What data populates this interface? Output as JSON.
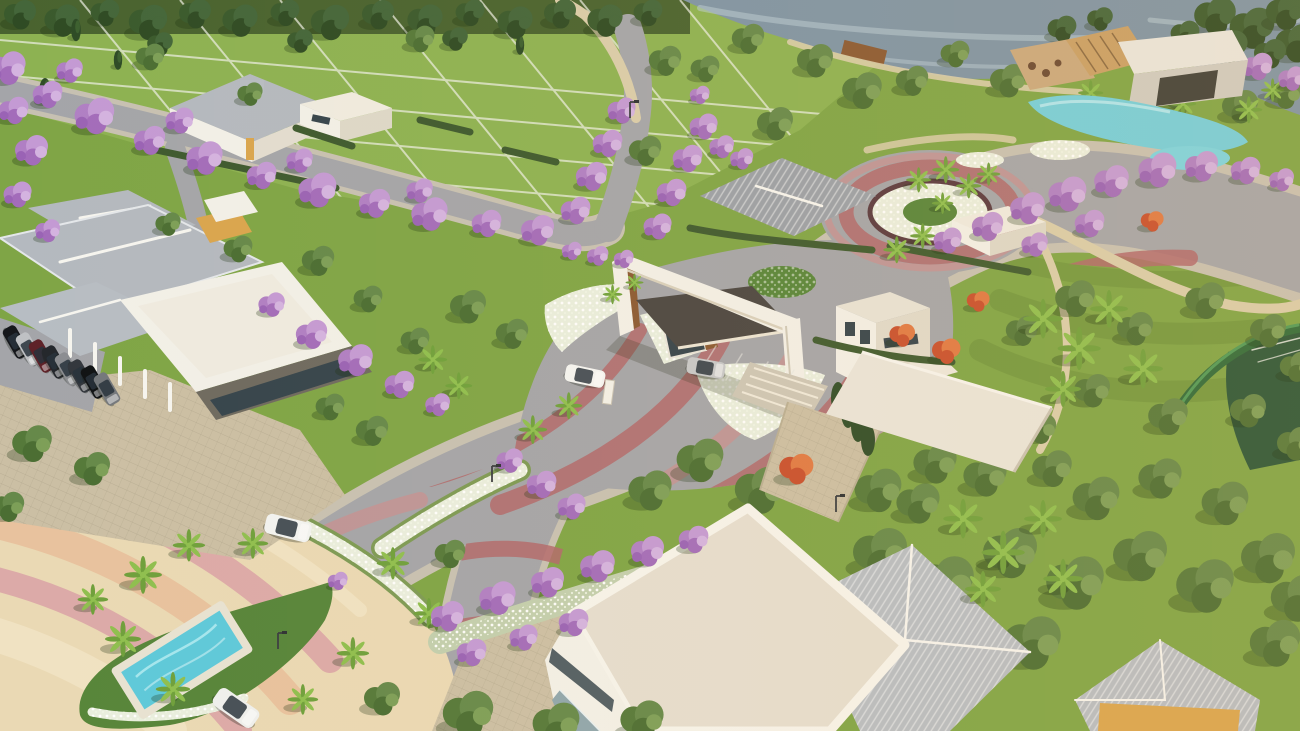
{
  "meta": {
    "title": "Aerial 3D render of a gated residential community entrance",
    "canvas": {
      "width": 1300,
      "height": 731
    }
  },
  "scene": {
    "description": "Sunset aerial rendering: main entrance portal with guard booth and canopy, curved boulevard with red decorative paving stripes, jacaranda-lined streets, landscaped roundabout, lakeside clubhouse with lagoon pools, residential lawn lots, palm islands with a small pool, sports court, and dense tree groves.",
    "landmarks": [
      "lake",
      "lakeside-clubhouse",
      "lagoon-pools",
      "boat-dock",
      "entrance-portal",
      "guard-booth",
      "roundabout-garden",
      "main-boulevard",
      "striped-plaza",
      "pool-island",
      "left-clubhouse",
      "parking-row",
      "white-flat-roof-building",
      "ribbed-roof-building",
      "sports-court",
      "residential-lots"
    ]
  },
  "palette": {
    "lawn": "#7fa546",
    "lawnLight": "#8db252",
    "forest": "#49632f",
    "water": "#7e94a5",
    "waterLight": "#bccfd9",
    "road": "#a4a5a9",
    "sidewalk": "#c7c1b2",
    "stripe": "#b2696c",
    "stripeLight": "#c98f90",
    "plazaCream": "#ead9b4",
    "bandPink": "#dcaaa8",
    "bandPeach": "#e8c29e",
    "bandLight": "#f0e2c2",
    "pathBeige": "#d9cdaa",
    "paver": "#cbbfa4",
    "white": "#f2f0e8",
    "cream": "#efebe0",
    "roofGray": "#b4b9bf",
    "roofRib": "#b7bdc3",
    "wood": "#8a5a33",
    "woodLight": "#c9a066",
    "canopy": "#4a4642",
    "glass": "#35444c",
    "yellow": "#d9a54e",
    "bedCream": "#e9eede",
    "bedGreen": "#7d9a55",
    "island": "#57853a",
    "pool": "#5ec9da",
    "deck": "#e8e2d2",
    "court": "#2a5638",
    "hedge": "#3e5a2f",
    "tree1": "#55793a",
    "tree2": "#66894a",
    "tree3": "#4b6e33",
    "tree4": "#7d9f58",
    "dark1": "#3a5a2d",
    "dark2": "#44663a",
    "dark3": "#2f4b24",
    "palm": "#6fa03c",
    "palmHi": "#8fbf4f",
    "trunk": "#7a6248",
    "jac1": "#b07fc4",
    "jac2": "#c49ad4",
    "jac3": "#a36cba",
    "jac4": "#d4b3e0",
    "jac5": "#9a63b5",
    "conif": "#2e4b26",
    "conifHi": "#3d6030",
    "flame1": "#c8502e",
    "flame2": "#e07a44",
    "shadow": "rgba(25,45,15,0.28)"
  },
  "vegetation": {
    "back": {
      "d": [
        [
          20,
          16,
          1.0
        ],
        [
          62,
          22,
          1.1
        ],
        [
          105,
          14,
          0.9
        ],
        [
          148,
          24,
          1.2
        ],
        [
          195,
          15,
          1.0
        ],
        [
          240,
          22,
          1.1
        ],
        [
          285,
          14,
          0.9
        ],
        [
          330,
          24,
          1.2
        ],
        [
          378,
          16,
          1.0
        ],
        [
          425,
          22,
          1.1
        ],
        [
          470,
          14,
          0.9
        ],
        [
          515,
          24,
          1.1
        ],
        [
          560,
          15,
          1.0
        ],
        [
          605,
          22,
          1.1
        ],
        [
          648,
          14,
          0.9
        ],
        [
          455,
          40,
          0.8
        ],
        [
          300,
          42,
          0.8
        ],
        [
          160,
          45,
          0.8
        ],
        [
          1215,
          18,
          1.3
        ],
        [
          1252,
          30,
          1.4
        ],
        [
          1285,
          14,
          1.2
        ],
        [
          1296,
          45,
          1.3
        ],
        [
          1230,
          48,
          1.1
        ],
        [
          1270,
          55,
          1.0
        ],
        [
          1185,
          35,
          0.9
        ],
        [
          1062,
          30,
          0.9
        ],
        [
          1100,
          20,
          0.8
        ]
      ],
      "c": [
        [
          45,
          92,
          1.0
        ],
        [
          76,
          30,
          0.8
        ],
        [
          520,
          45,
          0.7
        ],
        [
          118,
          60,
          0.7
        ]
      ],
      "t": [
        [
          748,
          40,
          0.9
        ],
        [
          815,
          62,
          1.0
        ],
        [
          862,
          92,
          1.1
        ],
        [
          912,
          82,
          0.9
        ],
        [
          955,
          55,
          0.8
        ],
        [
          1008,
          82,
          1.0
        ],
        [
          1175,
          92,
          1.1
        ],
        [
          1240,
          108,
          1.0
        ],
        [
          1285,
          95,
          0.9
        ],
        [
          705,
          70,
          0.8
        ],
        [
          150,
          58,
          0.8
        ],
        [
          420,
          40,
          0.8
        ],
        [
          665,
          62,
          0.9
        ],
        [
          775,
          125,
          1.0
        ],
        [
          645,
          152,
          0.9
        ],
        [
          250,
          95,
          0.7
        ],
        [
          168,
          225,
          0.7
        ],
        [
          238,
          250,
          0.8
        ],
        [
          1075,
          300,
          1.1
        ],
        [
          1135,
          330,
          1.0
        ],
        [
          1205,
          302,
          1.1
        ],
        [
          1268,
          332,
          1.0
        ],
        [
          1092,
          392,
          1.0
        ],
        [
          1168,
          418,
          1.1
        ],
        [
          1248,
          412,
          1.0
        ],
        [
          1296,
          368,
          0.9
        ],
        [
          1022,
          332,
          0.9
        ],
        [
          1040,
          430,
          0.9
        ],
        [
          1295,
          445,
          1.0
        ],
        [
          880,
          555,
          1.5
        ],
        [
          945,
          585,
          1.6
        ],
        [
          1010,
          555,
          1.5
        ],
        [
          1075,
          585,
          1.6
        ],
        [
          1140,
          558,
          1.5
        ],
        [
          1205,
          588,
          1.6
        ],
        [
          1268,
          560,
          1.5
        ],
        [
          1296,
          600,
          1.4
        ],
        [
          905,
          640,
          1.6
        ],
        [
          968,
          668,
          1.5
        ],
        [
          1032,
          645,
          1.6
        ],
        [
          1275,
          645,
          1.4
        ],
        [
          850,
          610,
          1.4
        ],
        [
          1096,
          500,
          1.3
        ],
        [
          1160,
          480,
          1.2
        ],
        [
          1225,
          505,
          1.3
        ],
        [
          918,
          505,
          1.2
        ],
        [
          985,
          478,
          1.2
        ],
        [
          1052,
          470,
          1.1
        ],
        [
          700,
          462,
          1.3
        ],
        [
          760,
          492,
          1.4
        ],
        [
          822,
          462,
          1.3
        ],
        [
          878,
          492,
          1.3
        ],
        [
          935,
          465,
          1.2
        ],
        [
          650,
          492,
          1.2
        ],
        [
          318,
          262,
          0.9
        ],
        [
          468,
          308,
          1.0
        ],
        [
          512,
          335,
          0.9
        ],
        [
          415,
          342,
          0.8
        ],
        [
          368,
          300,
          0.8
        ]
      ],
      "p": [
        [
          1152,
          92,
          0.7
        ],
        [
          1182,
          106,
          0.75
        ],
        [
          1212,
          86,
          0.7
        ],
        [
          1248,
          112,
          0.75
        ],
        [
          1272,
          92,
          0.65
        ],
        [
          1090,
          95,
          0.7
        ]
      ],
      "j": [
        [
          1258,
          68,
          0.9
        ],
        [
          1292,
          80,
          0.8
        ]
      ]
    },
    "front": {
      "t": [
        [
          32,
          445,
          1.1
        ],
        [
          92,
          470,
          1.0
        ],
        [
          8,
          508,
          0.9
        ],
        [
          468,
          716,
          1.4
        ],
        [
          556,
          726,
          1.3
        ],
        [
          642,
          722,
          1.2
        ],
        [
          382,
          700,
          1.0
        ],
        [
          372,
          432,
          0.9
        ],
        [
          330,
          408,
          0.8
        ],
        [
          450,
          555,
          0.85
        ]
      ],
      "p": [
        [
          142,
          578,
          1.05
        ],
        [
          188,
          548,
          0.9
        ],
        [
          122,
          642,
          1.0
        ],
        [
          172,
          692,
          0.95
        ],
        [
          92,
          602,
          0.85
        ],
        [
          392,
          566,
          0.9
        ],
        [
          428,
          616,
          0.85
        ],
        [
          352,
          656,
          0.9
        ],
        [
          302,
          702,
          0.85
        ],
        [
          252,
          546,
          0.85
        ],
        [
          432,
          362,
          0.8
        ],
        [
          458,
          388,
          0.75
        ],
        [
          532,
          432,
          0.8
        ],
        [
          568,
          408,
          0.75
        ],
        [
          612,
          296,
          0.55
        ],
        [
          634,
          284,
          0.5
        ],
        [
          896,
          252,
          0.75
        ],
        [
          922,
          238,
          0.7
        ],
        [
          918,
          182,
          0.7
        ],
        [
          945,
          172,
          0.75
        ],
        [
          968,
          188,
          0.7
        ],
        [
          988,
          176,
          0.65
        ],
        [
          942,
          205,
          0.6
        ],
        [
          1042,
          322,
          1.1
        ],
        [
          1078,
          352,
          1.2
        ],
        [
          1108,
          312,
          1.05
        ],
        [
          1142,
          372,
          1.1
        ],
        [
          1062,
          392,
          1.0
        ],
        [
          962,
          522,
          1.1
        ],
        [
          1002,
          556,
          1.2
        ],
        [
          1042,
          522,
          1.05
        ],
        [
          982,
          592,
          1.0
        ],
        [
          1062,
          582,
          1.1
        ]
      ],
      "j": [
        [
          8,
          70,
          1.1
        ],
        [
          48,
          96,
          0.9
        ],
        [
          95,
          118,
          1.2
        ],
        [
          150,
          142,
          0.95
        ],
        [
          205,
          160,
          1.1
        ],
        [
          262,
          177,
          0.9
        ],
        [
          318,
          192,
          1.15
        ],
        [
          375,
          205,
          0.95
        ],
        [
          430,
          216,
          1.1
        ],
        [
          487,
          225,
          0.9
        ],
        [
          538,
          232,
          1.0
        ],
        [
          70,
          72,
          0.8
        ],
        [
          180,
          122,
          0.85
        ],
        [
          300,
          162,
          0.8
        ],
        [
          420,
          192,
          0.8
        ],
        [
          14,
          112,
          0.9
        ],
        [
          32,
          152,
          1.0
        ],
        [
          18,
          196,
          0.85
        ],
        [
          48,
          232,
          0.75
        ],
        [
          272,
          306,
          0.8
        ],
        [
          312,
          336,
          0.95
        ],
        [
          356,
          362,
          1.05
        ],
        [
          400,
          386,
          0.9
        ],
        [
          438,
          406,
          0.75
        ],
        [
          576,
          212,
          0.9
        ],
        [
          592,
          178,
          0.95
        ],
        [
          608,
          145,
          0.9
        ],
        [
          622,
          112,
          0.85
        ],
        [
          658,
          228,
          0.85
        ],
        [
          672,
          194,
          0.9
        ],
        [
          688,
          160,
          0.9
        ],
        [
          704,
          128,
          0.85
        ],
        [
          722,
          148,
          0.75
        ],
        [
          742,
          160,
          0.7
        ],
        [
          700,
          96,
          0.6
        ],
        [
          572,
          252,
          0.6
        ],
        [
          598,
          257,
          0.65
        ],
        [
          624,
          260,
          0.6
        ],
        [
          948,
          242,
          0.85
        ],
        [
          988,
          228,
          0.95
        ],
        [
          1028,
          210,
          1.05
        ],
        [
          1068,
          196,
          1.15
        ],
        [
          1112,
          183,
          1.05
        ],
        [
          1158,
          172,
          1.15
        ],
        [
          1202,
          168,
          1.0
        ],
        [
          1246,
          172,
          0.9
        ],
        [
          1282,
          181,
          0.75
        ],
        [
          1035,
          246,
          0.8
        ],
        [
          1090,
          225,
          0.9
        ],
        [
          448,
          618,
          1.0
        ],
        [
          498,
          600,
          1.1
        ],
        [
          548,
          584,
          1.0
        ],
        [
          598,
          568,
          1.05
        ],
        [
          648,
          553,
          1.0
        ],
        [
          694,
          541,
          0.9
        ],
        [
          472,
          654,
          0.9
        ],
        [
          524,
          639,
          0.85
        ],
        [
          574,
          624,
          0.9
        ],
        [
          510,
          462,
          0.8
        ],
        [
          542,
          486,
          0.9
        ],
        [
          572,
          508,
          0.85
        ],
        [
          338,
          582,
          0.6
        ]
      ],
      "f": [
        [
          902,
          336,
          0.9
        ],
        [
          946,
          352,
          1.0
        ],
        [
          978,
          302,
          0.8
        ],
        [
          1152,
          222,
          0.8
        ],
        [
          796,
          470,
          1.2
        ]
      ],
      "d": [],
      "c": []
    }
  },
  "vehicles": [
    {
      "name": "white-suv-at-gate",
      "x": 585,
      "y": 376,
      "r": 12,
      "s": 1.25,
      "c": "#f4f5f3"
    },
    {
      "name": "silver-sedan-at-gate",
      "x": 706,
      "y": 368,
      "r": 10,
      "s": 1.2,
      "c": "#c6c8ca"
    },
    {
      "name": "white-sedan-on-road",
      "x": 288,
      "y": 528,
      "r": 14,
      "s": 1.45,
      "c": "#f2f3f1"
    },
    {
      "name": "white-car-bottom",
      "x": 236,
      "y": 708,
      "r": 35,
      "s": 1.5,
      "c": "#eff0ee"
    },
    {
      "name": "parked-car",
      "x": 16,
      "y": 342,
      "r": 60,
      "s": 1.05,
      "c": "#15171b"
    },
    {
      "name": "parked-car",
      "x": 29,
      "y": 349,
      "r": 60,
      "s": 1.05,
      "c": "#bfc1c4"
    },
    {
      "name": "parked-car",
      "x": 42,
      "y": 356,
      "r": 60,
      "s": 1.05,
      "c": "#5e2128"
    },
    {
      "name": "parked-car",
      "x": 55,
      "y": 362,
      "r": 60,
      "s": 1.05,
      "c": "#24272c"
    },
    {
      "name": "parked-car",
      "x": 68,
      "y": 369,
      "r": 60,
      "s": 1.05,
      "c": "#8b8d91"
    },
    {
      "name": "parked-car",
      "x": 81,
      "y": 376,
      "r": 60,
      "s": 1.05,
      "c": "#33373d"
    },
    {
      "name": "parked-car",
      "x": 94,
      "y": 382,
      "r": 60,
      "s": 1.05,
      "c": "#101214"
    },
    {
      "name": "parked-car",
      "x": 107,
      "y": 389,
      "r": 60,
      "s": 1.05,
      "c": "#75787c"
    }
  ],
  "lamps": [
    [
      492,
      478
    ],
    [
      278,
      645
    ],
    [
      630,
      114
    ],
    [
      836,
      508
    ]
  ]
}
